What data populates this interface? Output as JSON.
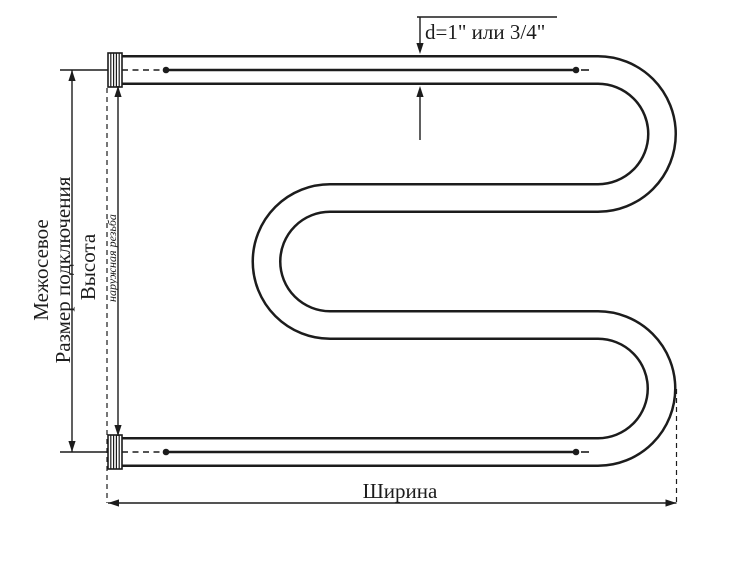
{
  "diagram": {
    "labels": {
      "interaxial": "Межосевое",
      "connection_size": "Размер подключения",
      "height": "Высота",
      "external_thread": "наружная резьба",
      "width": "Ширина",
      "diameter_note": "d=1\" или 3/4\""
    },
    "colors": {
      "ink": "#1c1c1c",
      "background": "#ffffff"
    }
  }
}
